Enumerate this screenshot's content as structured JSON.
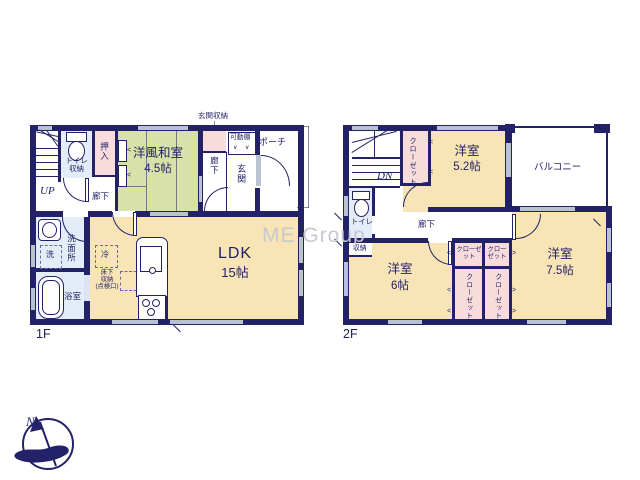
{
  "watermark": "ME Group",
  "compass": {
    "north": "N"
  },
  "colors": {
    "wall": "#232269",
    "room_beige": "#f8e4b4",
    "room_green": "#d8e2a8",
    "closet_pink": "#f8dcdc",
    "wet_blue": "#e4ecf7",
    "window_gray": "#b9c2d2"
  },
  "floor1": {
    "label": "1F",
    "stairs": {
      "direction": "UP"
    },
    "toilet": {
      "line1": "トイレ",
      "line2": "収納"
    },
    "oshiire": "押入",
    "japanese_room": {
      "name": "洋風和室",
      "size": "4.5帖"
    },
    "entrance_storage": "玄関収納",
    "movable_shelf": "可動棚",
    "shelf_mark": "∨",
    "hallway_side": "廊下",
    "hallway_lower": "廊下",
    "entrance": "玄関",
    "porch": "ポーチ",
    "washroom": "洗面所",
    "washer": "洗",
    "bathroom": "浴室",
    "refrigerator": "冷",
    "underfloor_storage": {
      "line1": "床下",
      "line2": "収納",
      "line3": "(点検口)"
    },
    "ldk": {
      "name": "LDK",
      "size": "15帖"
    }
  },
  "floor2": {
    "label": "2F",
    "stairs": {
      "direction": "DN"
    },
    "closet": "クローゼット",
    "closet_cells": "クローゼット",
    "room_52": {
      "name": "洋室",
      "size": "5.2帖"
    },
    "balcony": "バルコニー",
    "toilet": "トイレ",
    "storage": "収納",
    "hallway": "廊下",
    "room_6": {
      "name": "洋室",
      "size": "6帖"
    },
    "room_75": {
      "name": "洋室",
      "size": "7.5帖"
    }
  }
}
